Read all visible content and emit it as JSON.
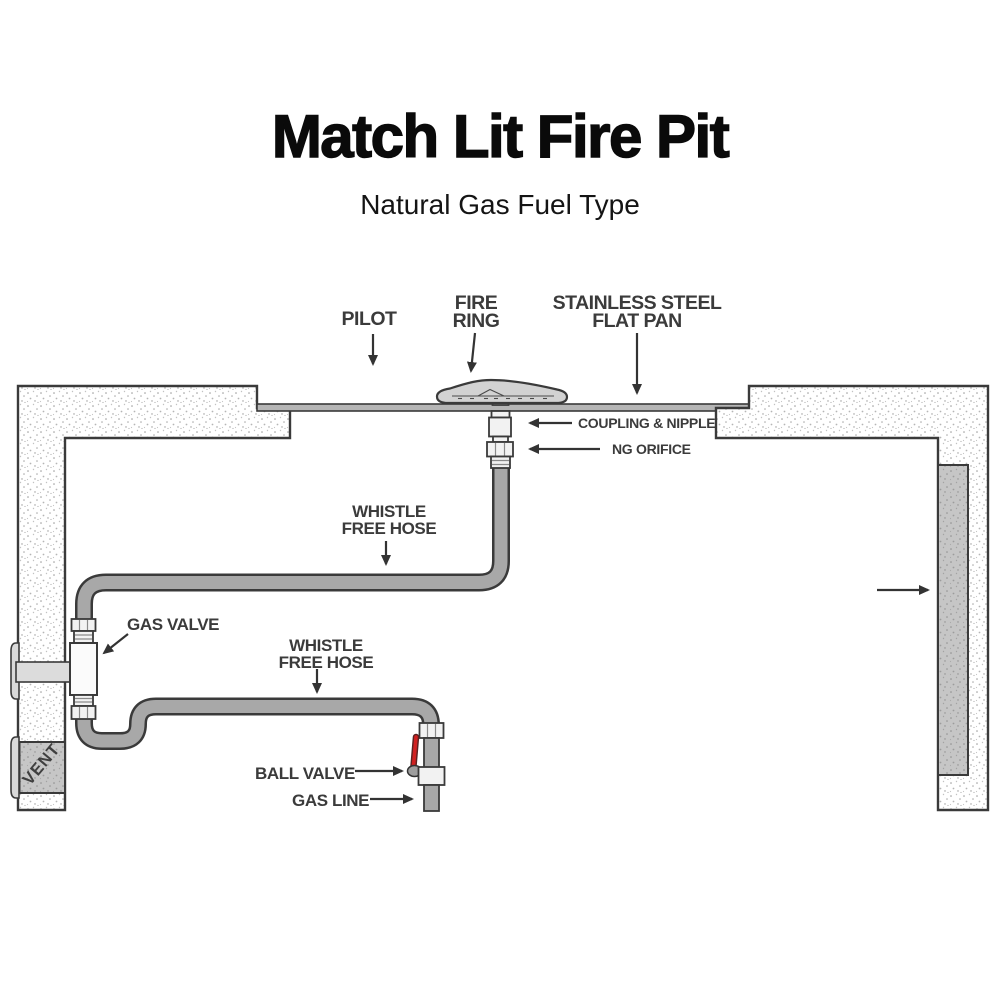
{
  "header": {
    "title": "Match Lit Fire Pit",
    "subtitle": "Natural Gas Fuel Type"
  },
  "diagram": {
    "labels": {
      "pilot": "PILOT",
      "fire_ring": {
        "line1": "FIRE",
        "line2": "RING"
      },
      "flat_pan": {
        "line1": "STAINLESS STEEL",
        "line2": "FLAT PAN"
      },
      "coupling_nipple": "COUPLING & NIPPLE",
      "ng_orifice": "NG ORIFICE",
      "whistle_free_hose_upper": {
        "line1": "WHISTLE",
        "line2": "FREE HOSE"
      },
      "gas_valve": "GAS VALVE",
      "whistle_free_hose_lower": {
        "line1": "WHISTLE",
        "line2": "FREE HOSE"
      },
      "ball_valve": "BALL VALVE",
      "gas_line": "GAS LINE",
      "vent": "VENT"
    },
    "colors": {
      "outline": "#3a3a3a",
      "label_text": "#3b3b3b",
      "hose_fill": "#a8a8a8",
      "fitting_fill": "#f2f2f2",
      "wall_gray": "#c9c9c9",
      "pan_fill": "#b5b5b5",
      "dome_fill": "#d2d2d2",
      "ball_valve_handle_red": "#d02020"
    }
  }
}
